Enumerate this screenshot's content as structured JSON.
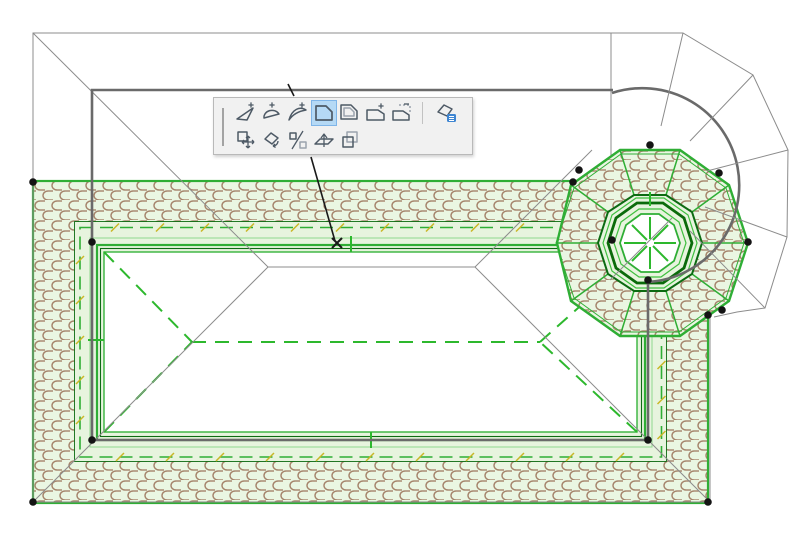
{
  "window": {
    "title": "roof-plan-editing-canvas",
    "background": "#ffffff"
  },
  "palette": {
    "name": "pet-palette",
    "selected_tool": "offset-edge",
    "row1": [
      {
        "icon": "insert-vertex",
        "selected": false
      },
      {
        "icon": "curve-edge",
        "selected": false
      },
      {
        "icon": "edit-curve",
        "selected": false
      },
      {
        "icon": "offset-edge",
        "selected": true
      },
      {
        "icon": "offset-all-edges",
        "selected": false
      },
      {
        "icon": "add-to-polygon",
        "selected": false
      },
      {
        "icon": "subtract-from-polygon",
        "selected": false
      },
      {
        "icon": "separator",
        "selected": false
      },
      {
        "icon": "tool-settings",
        "selected": false
      }
    ],
    "row2": [
      {
        "icon": "drag",
        "selected": false
      },
      {
        "icon": "rotate",
        "selected": false
      },
      {
        "icon": "mirror",
        "selected": false
      },
      {
        "icon": "elevate",
        "selected": false
      },
      {
        "icon": "multiply",
        "selected": false
      }
    ],
    "colors": {
      "background": "#f1f1f1",
      "border": "#b9b9b9",
      "selected_bg": "#b5d9f5",
      "selected_border": "#7fb5e8",
      "icon_stroke": "#4e5a66",
      "icon_light": "#9aa3ad",
      "accent_blue": "#3f86d2"
    }
  },
  "drawing": {
    "colors": {
      "roof_green": "#2fae35",
      "roof_green_dark": "#0c6b12",
      "roof_green_light": "#8fd98f",
      "roof_fill_pale": "#e7f4de",
      "tile_brown": "#a5846b",
      "tile_bg": "#eaf6e2",
      "pivot_tick_yellow": "#c9b727",
      "wall_gray": "#6a6a6a",
      "thin_line_gray": "#8c8c8c",
      "handle_black": "#141414"
    },
    "selection_handles": [
      [
        33,
        182
      ],
      [
        33,
        502
      ],
      [
        708,
        502
      ],
      [
        92,
        242
      ],
      [
        92,
        440
      ],
      [
        648,
        440
      ],
      [
        650,
        145
      ],
      [
        719,
        173
      ],
      [
        748,
        242
      ],
      [
        722,
        310
      ],
      [
        708,
        315
      ],
      [
        573,
        182
      ],
      [
        579,
        170
      ],
      [
        612,
        240
      ],
      [
        648,
        280
      ]
    ],
    "click_marker": {
      "x": 337,
      "y": 243
    },
    "leader": {
      "x1": 311,
      "y1": 157,
      "x2": 335,
      "y2": 241
    },
    "leader_tail": {
      "x1": 288,
      "y1": 84,
      "x2": 294,
      "y2": 96
    }
  }
}
